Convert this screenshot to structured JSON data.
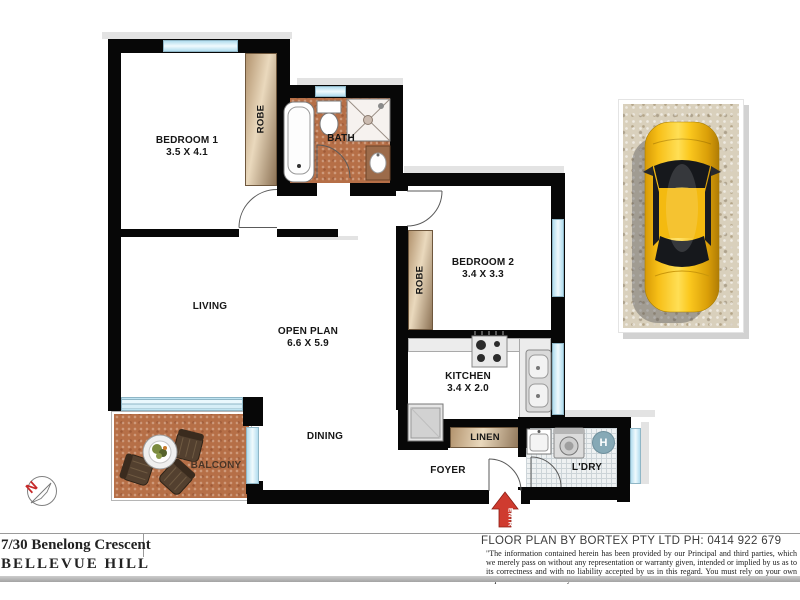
{
  "title_block": {
    "address_line1": "7/30 Benelong Crescent",
    "address_line2": "BELLEVUE HILL",
    "credit": "FLOOR PLAN BY BORTEX PTY LTD PH: 0414 922 679",
    "disclaimer": "\"The information contained herein has been provided by our Principal and third parties, which we merely pass on without any representation or warranty given, intended or implied by us as to its correctness and with no liability accepted by us in this regard. You must rely on your own inquiries as to its accuracy or otherwise.\""
  },
  "rooms": {
    "bedroom1": {
      "name": "BEDROOM 1",
      "dims": "3.5 X 4.1"
    },
    "bedroom2": {
      "name": "BEDROOM 2",
      "dims": "3.4 X 3.3"
    },
    "living": {
      "name": "LIVING"
    },
    "open_plan": {
      "name": "OPEN PLAN",
      "dims": "6.6 X 5.9"
    },
    "kitchen": {
      "name": "KITCHEN",
      "dims": "3.4 X 2.0"
    },
    "dining": {
      "name": "DINING"
    },
    "bath": {
      "name": "BATH"
    },
    "balcony": {
      "name": "BALCONY"
    },
    "foyer": {
      "name": "FOYER"
    },
    "laundry": {
      "name": "L'DRY"
    },
    "linen": {
      "name": "LINEN"
    },
    "robe_bedroom1": {
      "name": "ROBE"
    },
    "robe_bedroom2": {
      "name": "ROBE"
    }
  },
  "markers": {
    "entry_label": "ENTRY",
    "hot_water_label": "H",
    "north_label": "N"
  },
  "colors": {
    "wall": "#070707",
    "window_glass": "#cfeaf5",
    "tile_terracotta": "#b66f47",
    "joinery_tan": "#d8c2a0",
    "entry_arrow_red": "#cf3b2f",
    "car_yellow": "#f7bf17",
    "hot_water_circle": "#86a9b6"
  }
}
